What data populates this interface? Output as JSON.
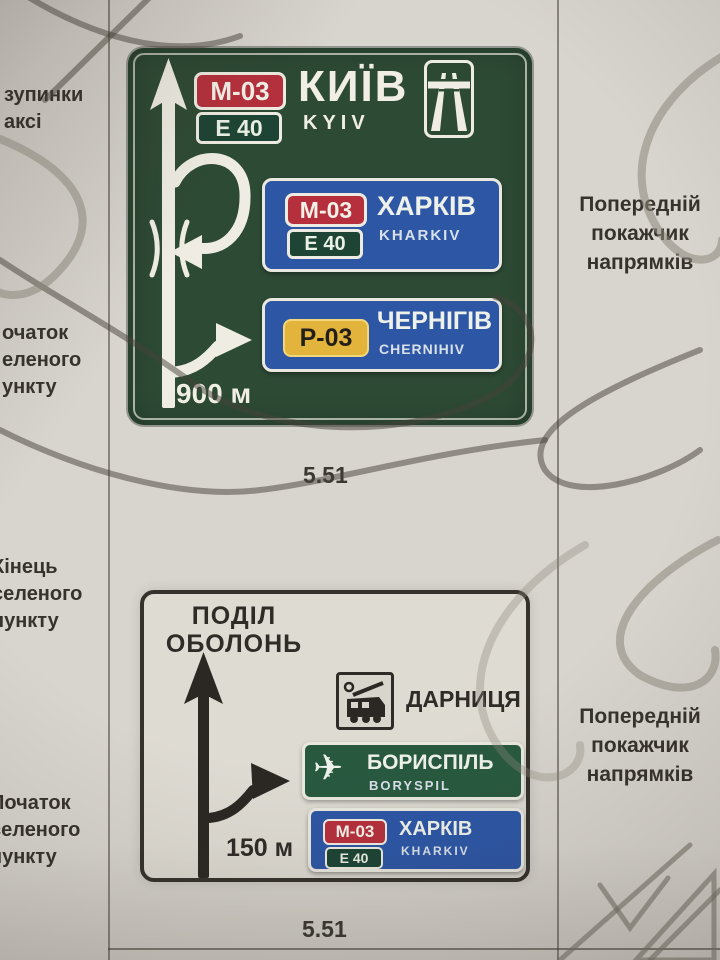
{
  "page": {
    "left_margin": {
      "block1": {
        "lines": [
          "зупинки",
          "аксі"
        ]
      },
      "block2": {
        "lines": [
          "очаток",
          "еленого",
          "ункту"
        ]
      },
      "block3": {
        "lines": [
          "Кінець",
          "селеного",
          "пункту"
        ]
      },
      "block4": {
        "lines": [
          "Початок",
          "селеного",
          "пункту"
        ]
      }
    },
    "right_margin": {
      "block1": {
        "lines": [
          "Попередній",
          "покажчик",
          "напрямків"
        ]
      },
      "block2": {
        "lines": [
          "Попередній",
          "покажчик",
          "напрямків"
        ]
      }
    }
  },
  "sign_top": {
    "code": "5.51",
    "route_badge": "М-03",
    "euro_badge": "Е 40",
    "city": "КИЇВ",
    "city_latin": "KYIV",
    "distance": "900 м",
    "panels": [
      {
        "route_badge": "М-03",
        "euro_badge": "Е 40",
        "city": "ХАРКІВ",
        "city_latin": "KHARKIV"
      },
      {
        "route_badge": "Р-03",
        "city": "ЧЕРНІГІВ",
        "city_latin": "CHERNIHIV"
      }
    ]
  },
  "sign_bottom": {
    "code": "5.51",
    "districts": [
      "ПОДІЛ",
      "ОБОЛОНЬ"
    ],
    "distance": "150 м",
    "rows": [
      {
        "icon": "train-icon",
        "city": "ДАРНИЦЯ"
      },
      {
        "icon": "airplane-icon",
        "city": "БОРИСПІЛЬ",
        "city_latin": "BORYSPIL"
      },
      {
        "route_badge": "М-03",
        "euro_badge": "Е 40",
        "city": "ХАРКІВ",
        "city_latin": "KHARKIV"
      }
    ]
  },
  "colors": {
    "paper": "#d8d5ce",
    "sign_green": "#2d4a35",
    "panel_blue": "#2d56a5",
    "panel_green": "#28593f",
    "badge_red": "#b5303c",
    "badge_euro_green": "#1d4434",
    "badge_yellow": "#e3b43c",
    "sign_white_bg": "#dedbd3",
    "ink": "#36332c",
    "sign_text": "#f0eee5"
  }
}
